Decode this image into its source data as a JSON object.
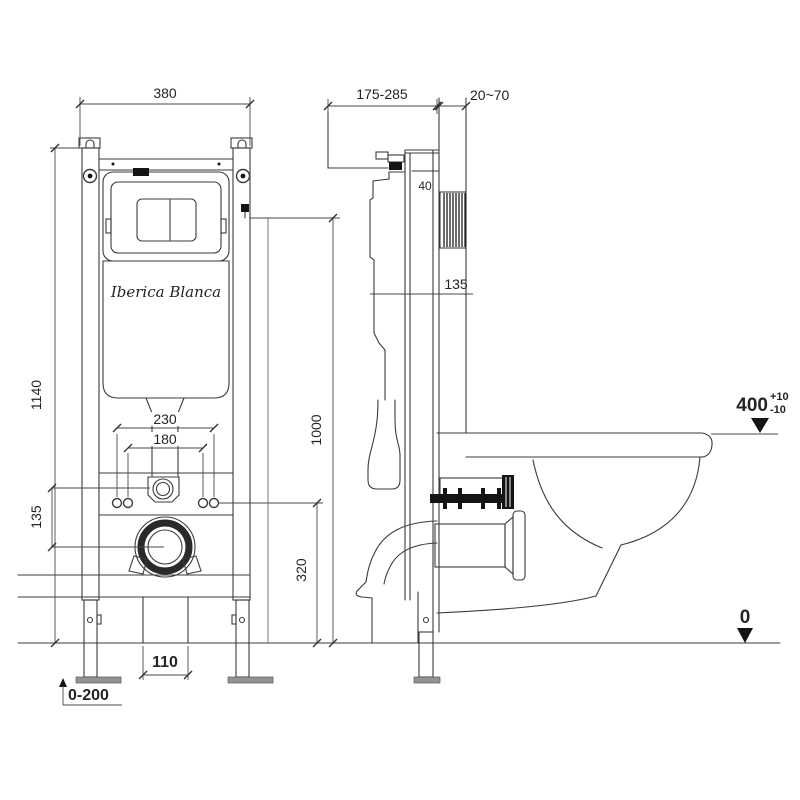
{
  "colors": {
    "line": "#3b3b3b",
    "text": "#242424",
    "dark_fill": "#141414",
    "foot_fill": "#909397",
    "background": "#ffffff"
  },
  "logo_script": "Iberica Blanca",
  "front": {
    "width": "380",
    "height": "1140",
    "bolt_span_outer": "230",
    "bolt_span_inner": "180",
    "inlet_to_drain": "135",
    "drain_height": "320",
    "reference_height": "1000",
    "outlet_width": "110",
    "foot_range": "0-200"
  },
  "side": {
    "depth_range": "175-285",
    "wall_finish": "20~70",
    "recess_depth": "40",
    "supply_offset": "135",
    "rim_height": "400",
    "rim_tol_plus": "+10",
    "rim_tol_minus": "-10",
    "floor": "0"
  }
}
